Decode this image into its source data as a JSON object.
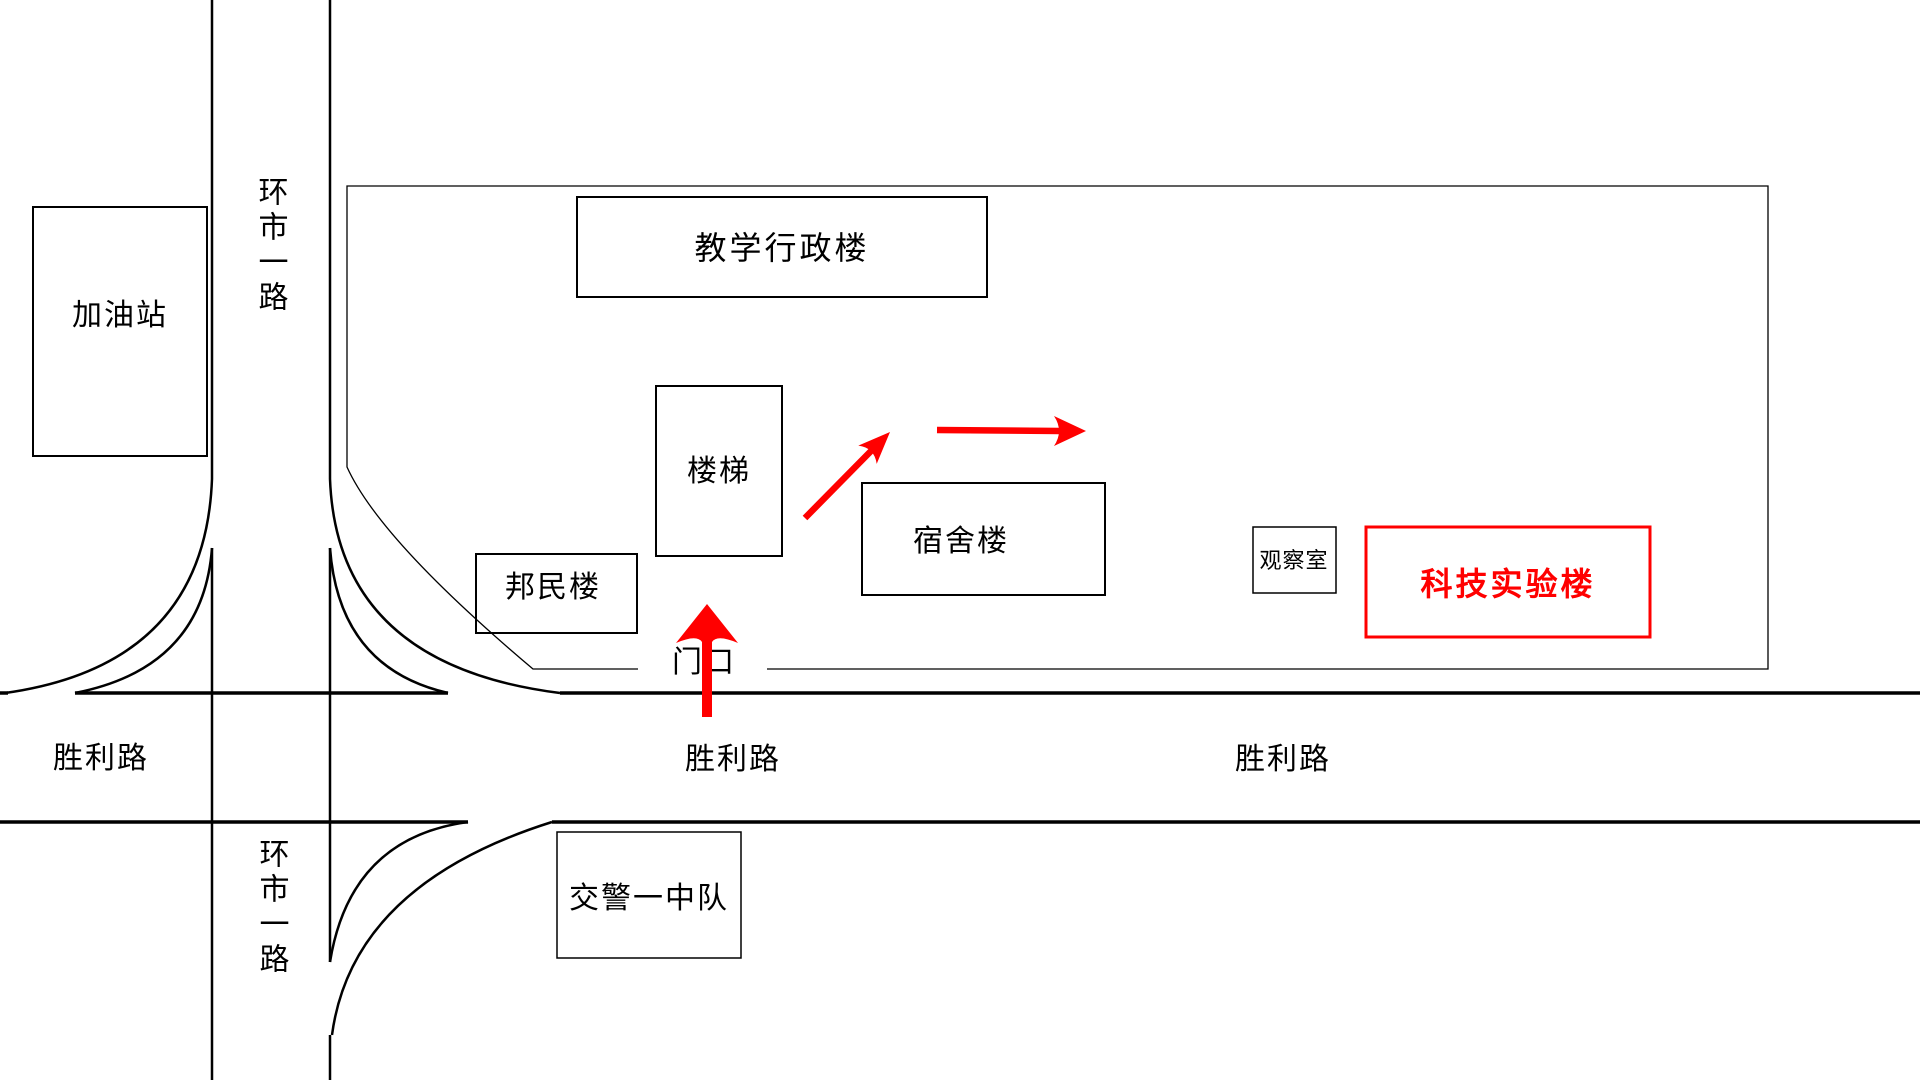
{
  "title": "校园位置示意图",
  "colors": {
    "line": "#000000",
    "route": "#ff0000",
    "background": "#ffffff",
    "highlight_building": "#ff0000"
  },
  "roads": {
    "huanshi": {
      "name": "环市一路",
      "label_top": "环市一路",
      "label_bottom": "环市一路",
      "orientation": "vertical"
    },
    "shengli": {
      "name": "胜利路",
      "labels": [
        "胜利路",
        "胜利路",
        "胜利路"
      ],
      "orientation": "horizontal"
    }
  },
  "gate": {
    "label": "门口"
  },
  "buildings": [
    {
      "id": "gas-station",
      "label": "加油站",
      "color": "#000000"
    },
    {
      "id": "teaching-admin",
      "label": "教学行政楼",
      "color": "#000000"
    },
    {
      "id": "stairs",
      "label": "楼梯",
      "color": "#000000"
    },
    {
      "id": "bangmin-building",
      "label": "邦民楼",
      "color": "#000000"
    },
    {
      "id": "dormitory",
      "label": "宿舍楼",
      "color": "#000000"
    },
    {
      "id": "observation-room",
      "label": "观察室",
      "color": "#000000"
    },
    {
      "id": "sci-tech-lab",
      "label": "科技实验楼",
      "color": "#ff0000",
      "highlighted": true
    },
    {
      "id": "traffic-police",
      "label": "交警一中队",
      "color": "#000000"
    }
  ],
  "route": {
    "color": "#ff0000",
    "arrows": [
      {
        "id": "entrance-arrow",
        "direction": "up",
        "from": "胜利路",
        "to": "门口"
      },
      {
        "id": "path-arrow-1",
        "direction": "up-right",
        "from": "楼梯",
        "to": "宿舍楼北侧"
      },
      {
        "id": "path-arrow-2",
        "direction": "right",
        "from": "宿舍楼北侧",
        "to": "科技实验楼方向"
      }
    ]
  }
}
